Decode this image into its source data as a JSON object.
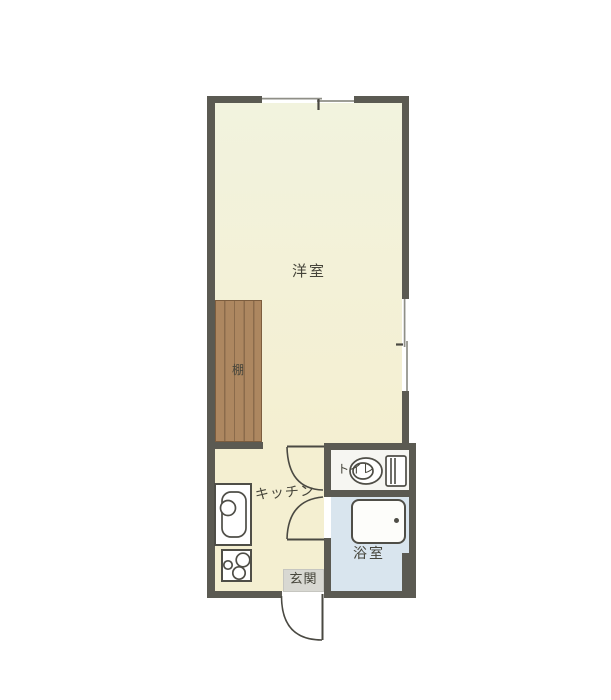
{
  "title": "apartment-floorplan",
  "labels": {
    "western_room": "洋室",
    "shelf": "棚",
    "kitchen": "キッチン",
    "toilet": "トイレ",
    "bathroom": "浴室",
    "entrance": "玄関"
  },
  "rooms": [
    {
      "id": "western-room",
      "label": "洋室"
    },
    {
      "id": "kitchen",
      "label": "キッチン"
    },
    {
      "id": "toilet",
      "label": "トイレ"
    },
    {
      "id": "bathroom",
      "label": "浴室"
    },
    {
      "id": "entrance",
      "label": "玄関"
    }
  ],
  "fixtures": [
    "shelf",
    "kitchen-sink",
    "gas-stove",
    "toilet",
    "bathtub",
    "sliding-window-top",
    "sliding-window-right",
    "room-door-swing",
    "bathroom-door-swing",
    "entrance-door-swing"
  ],
  "colors": {
    "wall": "#5b5a52",
    "line": "#4a4942",
    "window_line": "#8f8f87",
    "room_floor_top": "#f2f3de",
    "room_floor": "#f4efd1",
    "bathroom_floor": "#d9e5ee",
    "toilet_floor": "#f6f6f2",
    "entrance_floor": "#d8d8d2",
    "shelf": "#ad8760",
    "shelf_grain": "#8b6b4b",
    "shelf_border": "#7c5d3e",
    "fixture_border": "#4f4e47",
    "text": "#45443a",
    "bg": "#ffffff"
  }
}
